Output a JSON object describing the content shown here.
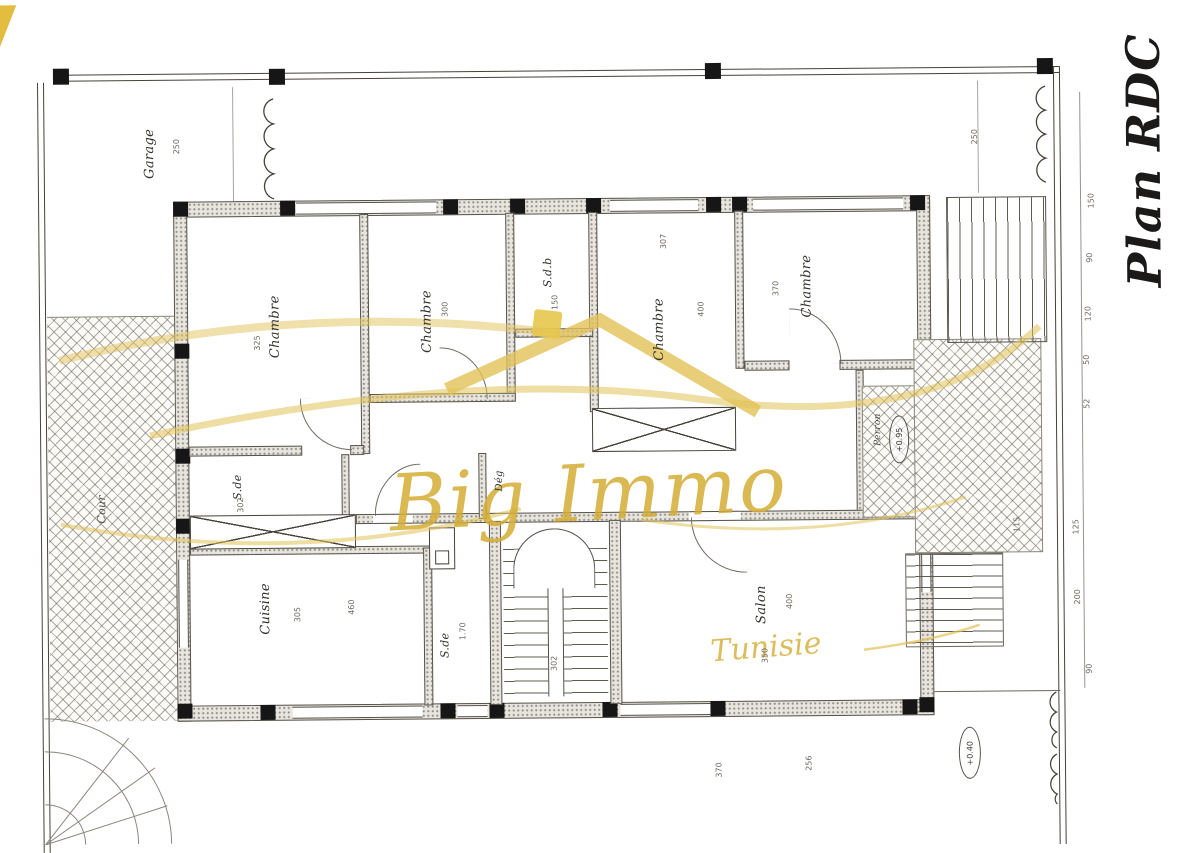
{
  "title": "Plan RDC",
  "watermark": {
    "brand": "Big Immo",
    "country": "Tunisie"
  },
  "palette": {
    "gold": "#d4ae36",
    "ink": "#34322d",
    "paper": "#ffffff"
  },
  "rooms": {
    "garage": "Garage",
    "chambre1": "Chambre",
    "chambre2": "Chambre",
    "sdb": "S.d.b",
    "chambre3": "Chambre",
    "chambre4": "Chambre",
    "sde1": "S.de",
    "cuisine": "Cuisine",
    "sde2": "S.de",
    "salon": "Salon",
    "deg": "Dég",
    "cour": "Cour",
    "perron": "Perron"
  },
  "levels": {
    "terrace": "+0.95",
    "entrance": "+0.40"
  },
  "dimensions": {
    "garage_left": "250",
    "garage_right": "250",
    "chambre1": "325",
    "chambre2": "300",
    "sdb": "150",
    "chambre3_a": "307",
    "chambre3_b": "400",
    "chambre4": "370",
    "sde1": "302",
    "cuisine_a": "305",
    "cuisine_b": "460",
    "sde2": "1.70",
    "stairs": "302",
    "salon_a": "400",
    "salon_b": "350",
    "bottom_a": "370",
    "bottom_b": "256",
    "right_a": "150",
    "right_b": "90",
    "right_c": "120",
    "right_d": "50",
    "right_e": "52",
    "right_f": "115",
    "right_g": "125",
    "right_h": "200",
    "right_i": "90"
  }
}
